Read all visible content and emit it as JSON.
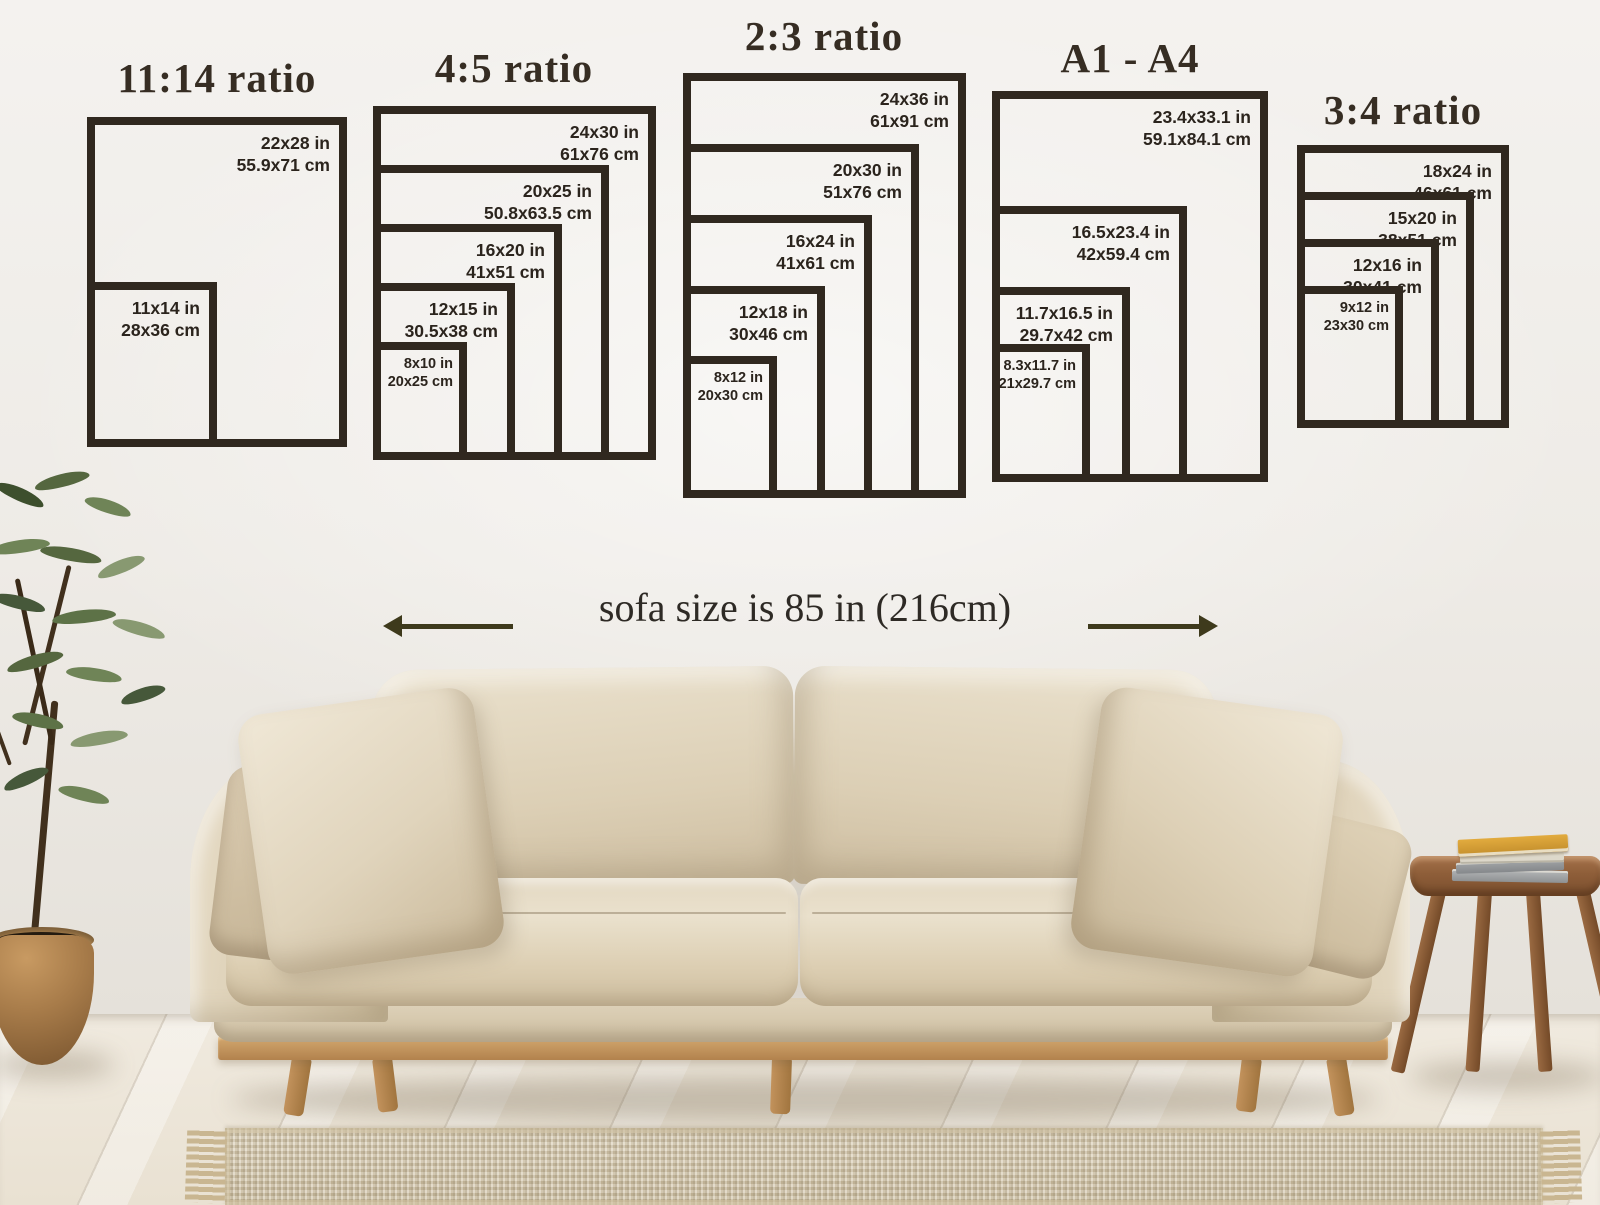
{
  "colors": {
    "frame_border": "#30281f",
    "title_text": "#362d23",
    "label_text": "#2b241d",
    "arrow": "#3e3a1c"
  },
  "icons": {
    "left_arrow": "left-arrow-icon",
    "right_arrow": "right-arrow-icon"
  },
  "sofa": {
    "size_label": "sofa size is 85 in (216cm)"
  },
  "groups": [
    {
      "title": "11:14 ratio",
      "boxes": [
        {
          "inches": "22x28 in",
          "cm": "55.9x71 cm"
        },
        {
          "inches": "11x14 in",
          "cm": "28x36 cm"
        }
      ]
    },
    {
      "title": "4:5 ratio",
      "boxes": [
        {
          "inches": "24x30 in",
          "cm": "61x76 cm"
        },
        {
          "inches": "20x25 in",
          "cm": "50.8x63.5 cm"
        },
        {
          "inches": "16x20 in",
          "cm": "41x51 cm"
        },
        {
          "inches": "12x15 in",
          "cm": "30.5x38 cm"
        },
        {
          "inches": "8x10 in",
          "cm": "20x25 cm"
        }
      ]
    },
    {
      "title": "2:3 ratio",
      "boxes": [
        {
          "inches": "24x36 in",
          "cm": "61x91 cm"
        },
        {
          "inches": "20x30 in",
          "cm": "51x76 cm"
        },
        {
          "inches": "16x24 in",
          "cm": "41x61 cm"
        },
        {
          "inches": "12x18 in",
          "cm": "30x46 cm"
        },
        {
          "inches": "8x12 in",
          "cm": "20x30 cm"
        }
      ]
    },
    {
      "title": "A1 - A4",
      "boxes": [
        {
          "inches": "23.4x33.1 in",
          "cm": "59.1x84.1 cm"
        },
        {
          "inches": "16.5x23.4 in",
          "cm": "42x59.4 cm"
        },
        {
          "inches": "11.7x16.5 in",
          "cm": "29.7x42 cm"
        },
        {
          "inches": "8.3x11.7 in",
          "cm": "21x29.7 cm"
        }
      ]
    },
    {
      "title": "3:4 ratio",
      "boxes": [
        {
          "inches": "18x24 in",
          "cm": "46x61 cm"
        },
        {
          "inches": "15x20 in",
          "cm": "38x51 cm"
        },
        {
          "inches": "12x16 in",
          "cm": "30x41 cm"
        },
        {
          "inches": "9x12 in",
          "cm": "23x30 cm"
        }
      ]
    }
  ]
}
